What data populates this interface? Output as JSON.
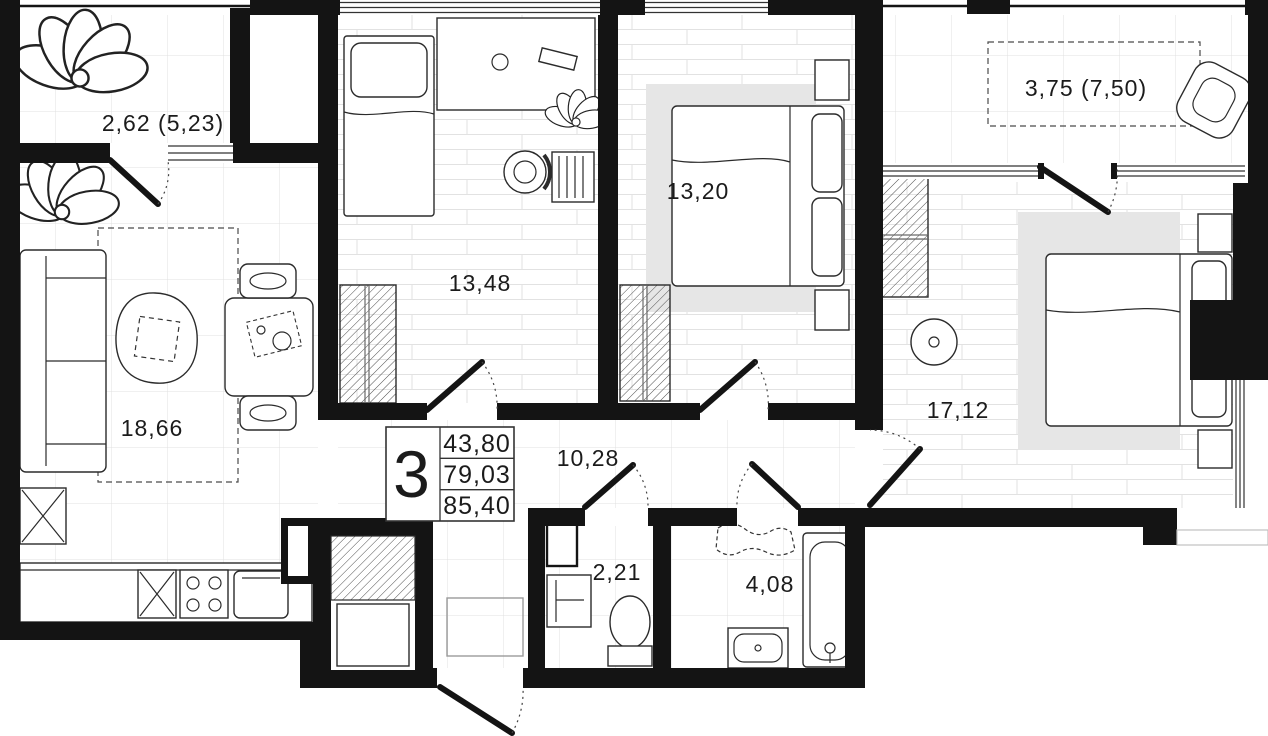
{
  "plan": {
    "kind": "apartment-floor-plan",
    "legend": {
      "rooms_count": "3",
      "rows": [
        "43,80",
        "79,03",
        "85,40"
      ]
    },
    "rooms": [
      {
        "id": "loggia-left",
        "label": "2,62 (5,23)"
      },
      {
        "id": "bedroom-1",
        "label": "13,48"
      },
      {
        "id": "bedroom-2",
        "label": "13,20"
      },
      {
        "id": "loggia-right",
        "label": "3,75 (7,50)"
      },
      {
        "id": "living-room",
        "label": "18,66"
      },
      {
        "id": "bedroom-3",
        "label": "17,12"
      },
      {
        "id": "hallway",
        "label": "10,28"
      },
      {
        "id": "wc",
        "label": "2,21"
      },
      {
        "id": "bathroom",
        "label": "4,08"
      }
    ],
    "colors": {
      "wall": "#141414",
      "line": "#2b2b2b",
      "grid": "#dfdfdf",
      "rug": "#e6e6e6",
      "paper": "#ffffff"
    }
  }
}
